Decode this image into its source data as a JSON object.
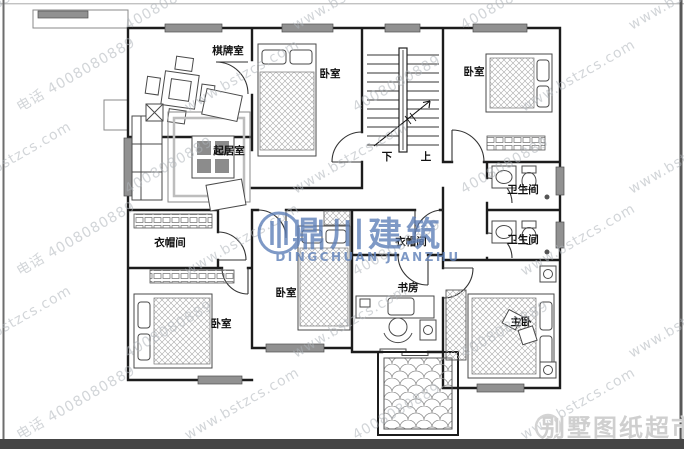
{
  "rooms": [
    {
      "id": "chess-room",
      "label": "棋牌室"
    },
    {
      "id": "bedroom-top-middle",
      "label": "卧室"
    },
    {
      "id": "bedroom-top-right",
      "label": "卧室"
    },
    {
      "id": "living-room",
      "label": "起居室"
    },
    {
      "id": "bathroom-upper",
      "label": "卫生间"
    },
    {
      "id": "bathroom-lower",
      "label": "卫生间"
    },
    {
      "id": "cloakroom-left",
      "label": "衣帽间"
    },
    {
      "id": "cloakroom-middle",
      "label": "衣帽间"
    },
    {
      "id": "bedroom-bottom-middle",
      "label": "卧室"
    },
    {
      "id": "bedroom-bottom-left",
      "label": "卧室"
    },
    {
      "id": "study",
      "label": "书房"
    },
    {
      "id": "master-bedroom",
      "label": "主卧"
    }
  ],
  "stairs": {
    "down": "下",
    "up": "上"
  },
  "watermark": {
    "site": "www.bstzcs.com",
    "phone": "4008080889",
    "phone_prefix": "电话"
  },
  "center_logo": {
    "cn": "鼎川建筑",
    "en": "DINGCHUAN JIANZHU",
    "color": "#5f80b8"
  },
  "corner_logo": {
    "text": "别墅图纸超市",
    "color": "#cfcfcf"
  },
  "colors": {
    "wall": "#1c1c1c",
    "window_fill": "#919191",
    "watermark": "#aeb4ba",
    "bottom_bar": "#454545"
  }
}
